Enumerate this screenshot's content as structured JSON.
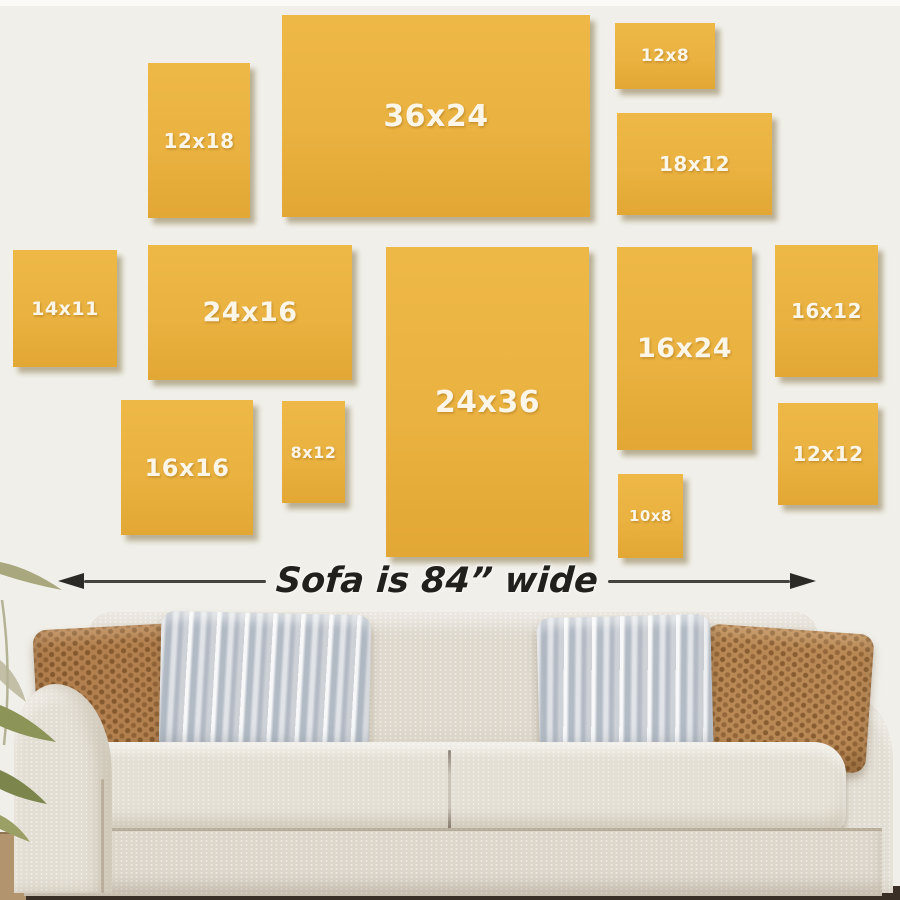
{
  "scene": {
    "description": "Wall art canvas size guide hung above a sofa",
    "wall_color": "#f0efe9",
    "canvas_color": "#eab240",
    "canvas_label_color": "#fcf6e9",
    "annotation_color": "#21201d",
    "sofa_fabric_color": "#ded8cd",
    "pillow_brown_color": "#b2804f",
    "pillow_gray_color": "#ced2d7",
    "floor_color": "#3a2f26"
  },
  "frames": {
    "f12x18": {
      "label": "12x18"
    },
    "f36x24": {
      "label": "36x24"
    },
    "f12x8": {
      "label": "12x8"
    },
    "f18x12": {
      "label": "18x12"
    },
    "f14x11": {
      "label": "14x11"
    },
    "f24x16": {
      "label": "24x16"
    },
    "f24x36": {
      "label": "24x36"
    },
    "f16x24": {
      "label": "16x24"
    },
    "f16x12": {
      "label": "16x12"
    },
    "f16x16": {
      "label": "16x16"
    },
    "f8x12": {
      "label": "8x12"
    },
    "f12x12": {
      "label": "12x12"
    },
    "f10x8": {
      "label": "10x8"
    }
  },
  "annotation": {
    "text": "Sofa is 84” wide"
  }
}
